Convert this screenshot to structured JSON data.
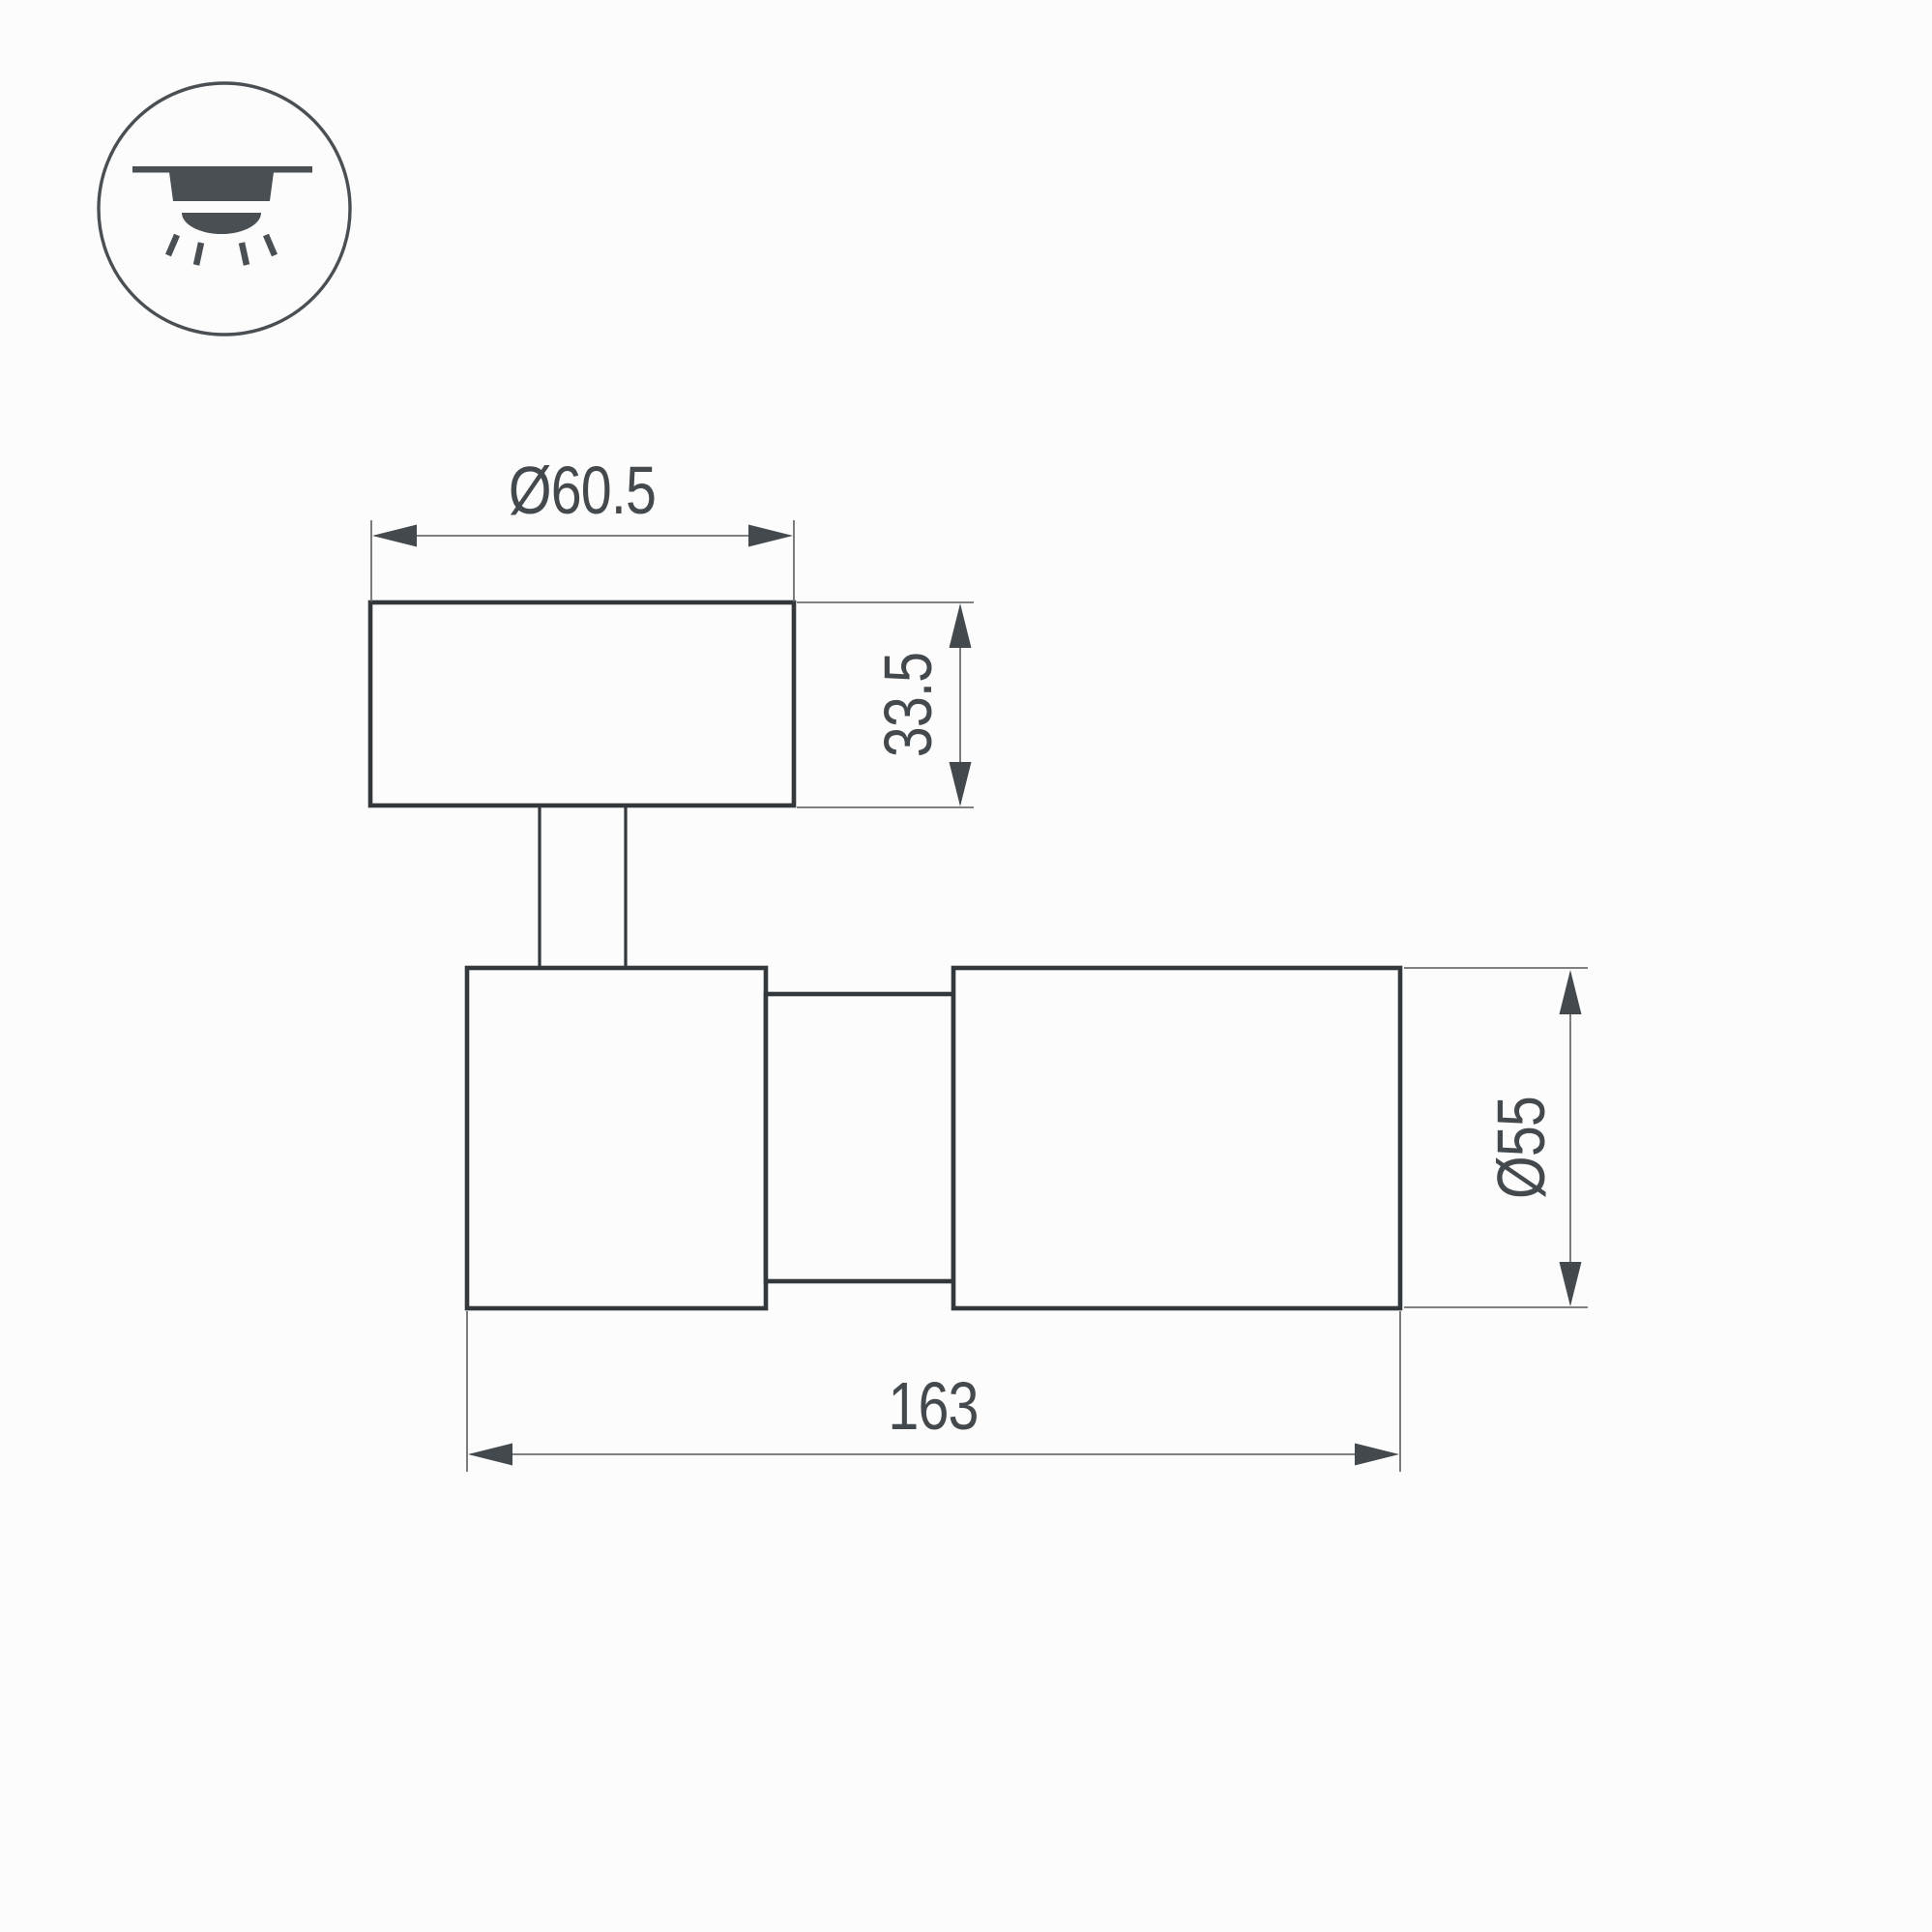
{
  "background": "#fcfcfc",
  "colors": {
    "outline": "#33383d",
    "thin_line": "#6e6e6e",
    "arrow_text": "#44494e",
    "icon": "#4a4f54"
  },
  "icon": {
    "label": "surface-mounted-ceiling-light"
  },
  "dimensions": {
    "top_width": "Ø60.5",
    "top_height": "33.5",
    "body_diameter": "Ø55",
    "body_length": "163"
  }
}
